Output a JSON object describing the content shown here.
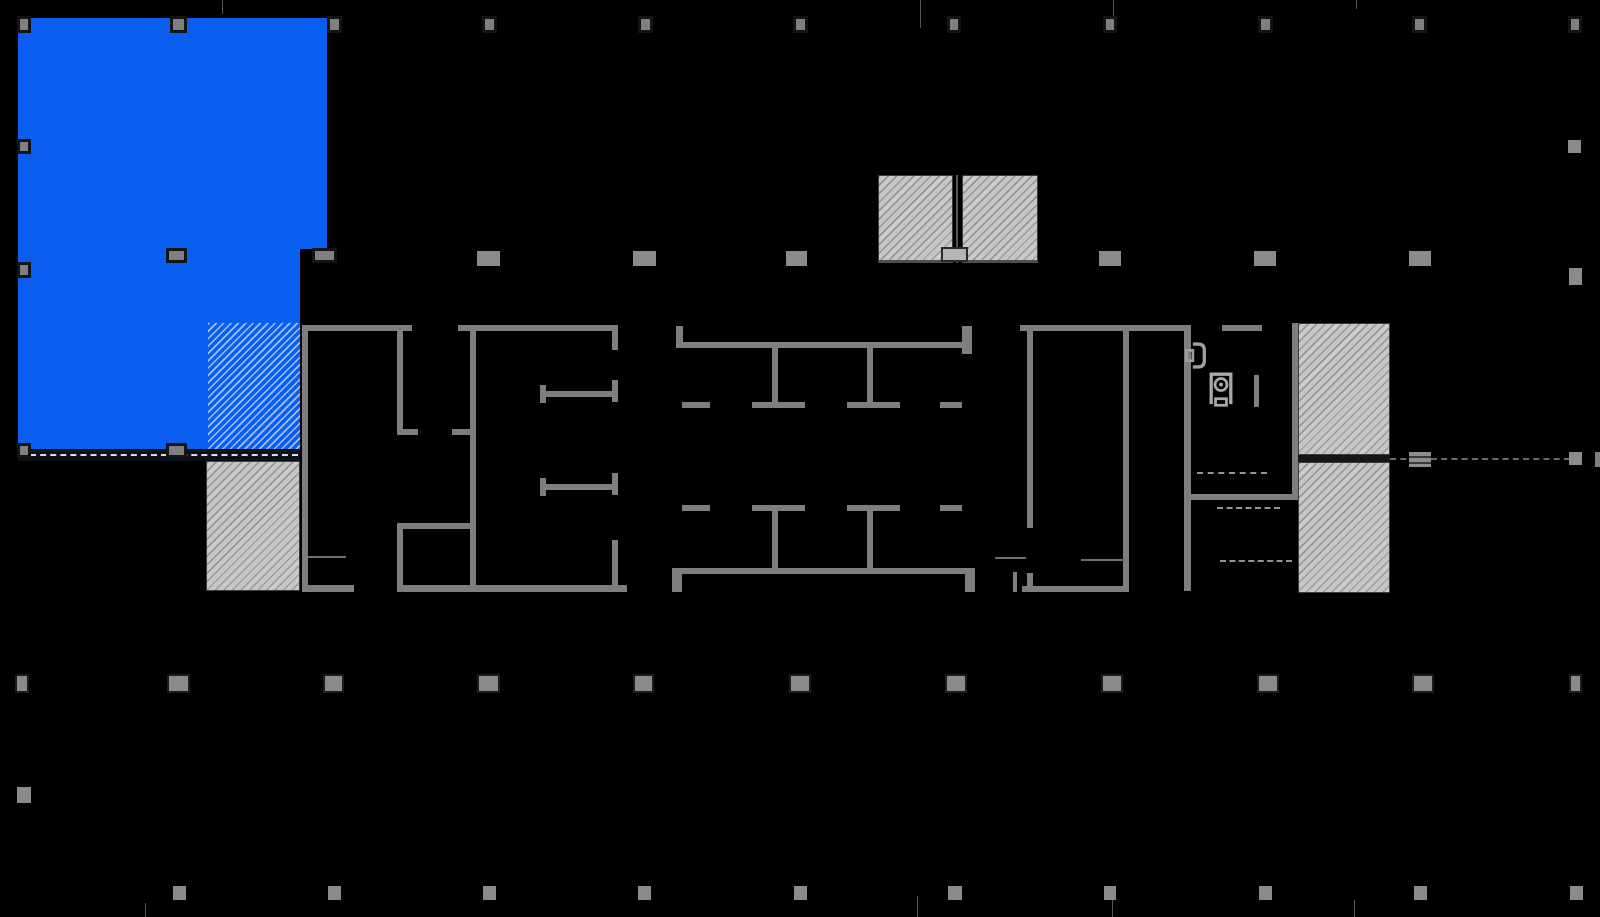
{
  "meta": {
    "width": 1600,
    "height": 917,
    "description": "building floor plan with highlighted suite"
  },
  "palette": {
    "background": "#000000",
    "wall_gray": "#7e7e7e",
    "suite_blue": "#0a5ff0",
    "hatch_gray": "#c6c6c6",
    "column_gray": "#8b8b8b"
  },
  "plan": {
    "elements": [
      {
        "name": "suite-highlight",
        "cls": "suite",
        "x": 18,
        "y": 18,
        "w": 309,
        "h": 231,
        "interactable": true
      },
      {
        "name": "suite-highlight",
        "cls": "suite",
        "x": 18,
        "y": 249,
        "w": 282,
        "h": 206,
        "interactable": true
      },
      {
        "name": "suite-highlight-hatched",
        "cls": "suite-hatch",
        "x": 208,
        "y": 323,
        "w": 92,
        "h": 132,
        "interactable": true
      },
      {
        "name": "suite-boundary-dashed",
        "cls": "suite-band",
        "x": 18,
        "y": 449,
        "w": 282,
        "h": 12
      },
      {
        "name": "shaft-hatch",
        "cls": "gray-hatch",
        "x": 206,
        "y": 461,
        "w": 94,
        "h": 130
      },
      {
        "name": "shaft-hatch",
        "cls": "gray-hatch shaft-top",
        "x": 878,
        "y": 175,
        "w": 75,
        "h": 88
      },
      {
        "name": "shaft-hatch",
        "cls": "gray-hatch shaft-top",
        "x": 962,
        "y": 175,
        "w": 76,
        "h": 88
      },
      {
        "name": "shaft-divider",
        "cls": "grid-tick",
        "x": 956,
        "y": 175,
        "w": 2,
        "h": 88
      },
      {
        "name": "shaft-door",
        "cls": "shaft-door",
        "x": 941,
        "y": 247,
        "w": 27,
        "h": 15
      },
      {
        "name": "shaft-hatch",
        "cls": "gray-hatch",
        "x": 1298,
        "y": 323,
        "w": 92,
        "h": 132
      },
      {
        "name": "shaft-hatch",
        "cls": "gray-hatch",
        "x": 1298,
        "y": 462,
        "w": 92,
        "h": 131
      },
      {
        "name": "shaft-gap-band",
        "cls": "dark-band",
        "x": 1298,
        "y": 455,
        "w": 92,
        "h": 7
      },
      {
        "name": "wall",
        "cls": "wall",
        "x": 302,
        "y": 325,
        "w": 6,
        "h": 266
      },
      {
        "name": "wall",
        "cls": "wall",
        "x": 302,
        "y": 325,
        "w": 110,
        "h": 6
      },
      {
        "name": "wall",
        "cls": "wall",
        "x": 458,
        "y": 325,
        "w": 160,
        "h": 6
      },
      {
        "name": "wall",
        "cls": "wall",
        "x": 397,
        "y": 331,
        "w": 6,
        "h": 103
      },
      {
        "name": "wall",
        "cls": "wall",
        "x": 397,
        "y": 429,
        "w": 21,
        "h": 6
      },
      {
        "name": "wall",
        "cls": "wall",
        "x": 452,
        "y": 429,
        "w": 24,
        "h": 6
      },
      {
        "name": "wall",
        "cls": "wall",
        "x": 470,
        "y": 331,
        "w": 6,
        "h": 260
      },
      {
        "name": "wall",
        "cls": "wall",
        "x": 397,
        "y": 523,
        "w": 79,
        "h": 6
      },
      {
        "name": "wall",
        "cls": "wall",
        "x": 397,
        "y": 529,
        "w": 6,
        "h": 62
      },
      {
        "name": "wall",
        "cls": "wall",
        "x": 540,
        "y": 391,
        "w": 78,
        "h": 6
      },
      {
        "name": "wall",
        "cls": "wall",
        "x": 540,
        "y": 385,
        "w": 6,
        "h": 18
      },
      {
        "name": "wall",
        "cls": "wall",
        "x": 540,
        "y": 484,
        "w": 78,
        "h": 6
      },
      {
        "name": "wall",
        "cls": "wall",
        "x": 540,
        "y": 478,
        "w": 6,
        "h": 18
      },
      {
        "name": "wall",
        "cls": "wall",
        "x": 612,
        "y": 325,
        "w": 6,
        "h": 25
      },
      {
        "name": "wall",
        "cls": "wall",
        "x": 612,
        "y": 380,
        "w": 6,
        "h": 22
      },
      {
        "name": "wall",
        "cls": "wall",
        "x": 612,
        "y": 473,
        "w": 6,
        "h": 22
      },
      {
        "name": "wall",
        "cls": "wall",
        "x": 612,
        "y": 540,
        "w": 6,
        "h": 52
      },
      {
        "name": "wall",
        "cls": "wall",
        "x": 302,
        "y": 585,
        "w": 52,
        "h": 7
      },
      {
        "name": "wall",
        "cls": "wall",
        "x": 397,
        "y": 585,
        "w": 230,
        "h": 7
      },
      {
        "name": "counter-line",
        "cls": "thin-line",
        "x": 308,
        "y": 556,
        "w": 38,
        "h": 2
      },
      {
        "name": "wall",
        "cls": "wall",
        "x": 676,
        "y": 326,
        "w": 7,
        "h": 22
      },
      {
        "name": "wall",
        "cls": "wall",
        "x": 962,
        "y": 326,
        "w": 10,
        "h": 28
      },
      {
        "name": "wall",
        "cls": "wall",
        "x": 682,
        "y": 342,
        "w": 280,
        "h": 6
      },
      {
        "name": "wall",
        "cls": "wall",
        "x": 772,
        "y": 348,
        "w": 6,
        "h": 60
      },
      {
        "name": "wall",
        "cls": "wall",
        "x": 867,
        "y": 348,
        "w": 6,
        "h": 60
      },
      {
        "name": "wall",
        "cls": "wall",
        "x": 682,
        "y": 402,
        "w": 28,
        "h": 6
      },
      {
        "name": "wall",
        "cls": "wall",
        "x": 752,
        "y": 402,
        "w": 53,
        "h": 6
      },
      {
        "name": "wall",
        "cls": "wall",
        "x": 847,
        "y": 402,
        "w": 53,
        "h": 6
      },
      {
        "name": "wall",
        "cls": "wall",
        "x": 940,
        "y": 402,
        "w": 22,
        "h": 6
      },
      {
        "name": "wall",
        "cls": "wall",
        "x": 682,
        "y": 505,
        "w": 28,
        "h": 6
      },
      {
        "name": "wall",
        "cls": "wall",
        "x": 752,
        "y": 505,
        "w": 53,
        "h": 6
      },
      {
        "name": "wall",
        "cls": "wall",
        "x": 847,
        "y": 505,
        "w": 53,
        "h": 6
      },
      {
        "name": "wall",
        "cls": "wall",
        "x": 940,
        "y": 505,
        "w": 22,
        "h": 6
      },
      {
        "name": "wall",
        "cls": "wall",
        "x": 772,
        "y": 511,
        "w": 6,
        "h": 57
      },
      {
        "name": "wall",
        "cls": "wall",
        "x": 867,
        "y": 511,
        "w": 6,
        "h": 57
      },
      {
        "name": "wall",
        "cls": "wall",
        "x": 682,
        "y": 568,
        "w": 283,
        "h": 6
      },
      {
        "name": "wall",
        "cls": "wall",
        "x": 672,
        "y": 568,
        "w": 10,
        "h": 24
      },
      {
        "name": "wall",
        "cls": "wall",
        "x": 965,
        "y": 568,
        "w": 10,
        "h": 24
      },
      {
        "name": "wall",
        "cls": "wall",
        "x": 1013,
        "y": 572,
        "w": 4,
        "h": 20
      },
      {
        "name": "door-line",
        "cls": "thin-line",
        "x": 995,
        "y": 557,
        "w": 31,
        "h": 2
      },
      {
        "name": "wall",
        "cls": "wall",
        "x": 1020,
        "y": 325,
        "w": 170,
        "h": 6
      },
      {
        "name": "wall",
        "cls": "wall",
        "x": 1222,
        "y": 325,
        "w": 40,
        "h": 6
      },
      {
        "name": "wall",
        "cls": "wall",
        "x": 1027,
        "y": 331,
        "w": 6,
        "h": 197
      },
      {
        "name": "wall",
        "cls": "wall",
        "x": 1027,
        "y": 573,
        "w": 6,
        "h": 19
      },
      {
        "name": "wall",
        "cls": "wall",
        "x": 1123,
        "y": 331,
        "w": 6,
        "h": 261
      },
      {
        "name": "wall",
        "cls": "wall",
        "x": 1022,
        "y": 586,
        "w": 107,
        "h": 6
      },
      {
        "name": "wall",
        "cls": "wall",
        "x": 1184,
        "y": 325,
        "w": 7,
        "h": 266
      },
      {
        "name": "wall",
        "cls": "wall",
        "x": 1292,
        "y": 323,
        "w": 6,
        "h": 177
      },
      {
        "name": "wall",
        "cls": "wall",
        "x": 1184,
        "y": 494,
        "w": 114,
        "h": 6
      },
      {
        "name": "wall",
        "cls": "wall",
        "x": 1254,
        "y": 375,
        "w": 5,
        "h": 32
      },
      {
        "name": "counter-line",
        "cls": "thin-line",
        "x": 1081,
        "y": 559,
        "w": 44,
        "h": 2
      },
      {
        "name": "wall",
        "cls": "wall",
        "x": 1595,
        "y": 452,
        "w": 5,
        "h": 15
      },
      {
        "name": "dashed-partition",
        "cls": "dash",
        "x": 1197,
        "y": 472,
        "w": 70
      },
      {
        "name": "dashed-partition",
        "cls": "dash",
        "x": 1217,
        "y": 507,
        "w": 63
      },
      {
        "name": "dashed-partition",
        "cls": "dash",
        "x": 1220,
        "y": 560,
        "w": 72
      },
      {
        "name": "dashed-gridline",
        "cls": "dash-dim",
        "x": 1390,
        "y": 458,
        "w": 180
      },
      {
        "name": "grid-tick",
        "cls": "grid-tick",
        "x": 222,
        "y": 0,
        "w": 1,
        "h": 14
      },
      {
        "name": "grid-tick",
        "cls": "grid-tick",
        "x": 920,
        "y": 0,
        "w": 1,
        "h": 28
      },
      {
        "name": "grid-tick",
        "cls": "grid-tick",
        "x": 1113,
        "y": 0,
        "w": 1,
        "h": 28
      },
      {
        "name": "grid-tick",
        "cls": "grid-tick",
        "x": 1356,
        "y": 0,
        "w": 1,
        "h": 9
      },
      {
        "name": "grid-tick",
        "cls": "grid-tick",
        "x": 145,
        "y": 903,
        "w": 1,
        "h": 14
      },
      {
        "name": "grid-tick",
        "cls": "grid-tick",
        "x": 917,
        "y": 896,
        "w": 1,
        "h": 21
      },
      {
        "name": "grid-tick",
        "cls": "grid-tick",
        "x": 1112,
        "y": 896,
        "w": 1,
        "h": 21
      },
      {
        "name": "grid-tick",
        "cls": "grid-tick",
        "x": 1354,
        "y": 900,
        "w": 1,
        "h": 17
      },
      {
        "name": "structural-column",
        "cls": "col-b",
        "x": 17,
        "y": 16,
        "w": 14,
        "h": 17
      },
      {
        "name": "structural-column",
        "cls": "col-b",
        "x": 170,
        "y": 16,
        "w": 17,
        "h": 17
      },
      {
        "name": "structural-column",
        "cls": "col-b",
        "x": 327,
        "y": 16,
        "w": 15,
        "h": 17
      },
      {
        "name": "structural-column",
        "cls": "col-b",
        "x": 482,
        "y": 16,
        "w": 15,
        "h": 17
      },
      {
        "name": "structural-column",
        "cls": "col-b",
        "x": 638,
        "y": 16,
        "w": 15,
        "h": 17
      },
      {
        "name": "structural-column",
        "cls": "col-b",
        "x": 793,
        "y": 16,
        "w": 15,
        "h": 17
      },
      {
        "name": "structural-column",
        "cls": "col-b",
        "x": 947,
        "y": 16,
        "w": 14,
        "h": 17
      },
      {
        "name": "structural-column",
        "cls": "col-b",
        "x": 1103,
        "y": 16,
        "w": 14,
        "h": 17
      },
      {
        "name": "structural-column",
        "cls": "col-b",
        "x": 1258,
        "y": 16,
        "w": 15,
        "h": 17
      },
      {
        "name": "structural-column",
        "cls": "col-b",
        "x": 1412,
        "y": 16,
        "w": 15,
        "h": 17
      },
      {
        "name": "structural-column",
        "cls": "col-b",
        "x": 1568,
        "y": 16,
        "w": 14,
        "h": 17
      },
      {
        "name": "structural-column",
        "cls": "col-b",
        "x": 17,
        "y": 139,
        "w": 14,
        "h": 15
      },
      {
        "name": "structural-column",
        "cls": "col-p",
        "x": 1568,
        "y": 140,
        "w": 13,
        "h": 13
      },
      {
        "name": "structural-column",
        "cls": "col-b",
        "x": 166,
        "y": 248,
        "w": 21,
        "h": 15
      },
      {
        "name": "structural-column",
        "cls": "col-b",
        "x": 312,
        "y": 248,
        "w": 25,
        "h": 15
      },
      {
        "name": "structural-column",
        "cls": "col-p",
        "x": 477,
        "y": 251,
        "w": 23,
        "h": 15
      },
      {
        "name": "structural-column",
        "cls": "col-p",
        "x": 633,
        "y": 251,
        "w": 23,
        "h": 15
      },
      {
        "name": "structural-column",
        "cls": "col-p",
        "x": 786,
        "y": 251,
        "w": 21,
        "h": 15
      },
      {
        "name": "structural-column",
        "cls": "col-p",
        "x": 1099,
        "y": 251,
        "w": 22,
        "h": 15
      },
      {
        "name": "structural-column",
        "cls": "col-p",
        "x": 1254,
        "y": 251,
        "w": 22,
        "h": 15
      },
      {
        "name": "structural-column",
        "cls": "col-p",
        "x": 1409,
        "y": 251,
        "w": 22,
        "h": 15
      },
      {
        "name": "structural-column",
        "cls": "col-b",
        "x": 17,
        "y": 262,
        "w": 14,
        "h": 16
      },
      {
        "name": "structural-column",
        "cls": "col-p",
        "x": 1569,
        "y": 268,
        "w": 13,
        "h": 17
      },
      {
        "name": "structural-column",
        "cls": "col-b",
        "x": 17,
        "y": 443,
        "w": 14,
        "h": 15
      },
      {
        "name": "structural-column",
        "cls": "col-b",
        "x": 166,
        "y": 443,
        "w": 21,
        "h": 15
      },
      {
        "name": "structural-column",
        "cls": "col-s",
        "x": 1409,
        "y": 452,
        "w": 22,
        "h": 15
      },
      {
        "name": "structural-column",
        "cls": "col-p",
        "x": 1569,
        "y": 452,
        "w": 13,
        "h": 13
      },
      {
        "name": "structural-column",
        "cls": "col-d",
        "x": 15,
        "y": 674,
        "w": 14,
        "h": 19
      },
      {
        "name": "structural-column",
        "cls": "col-d",
        "x": 167,
        "y": 674,
        "w": 23,
        "h": 19
      },
      {
        "name": "structural-column",
        "cls": "col-d",
        "x": 323,
        "y": 674,
        "w": 21,
        "h": 19
      },
      {
        "name": "structural-column",
        "cls": "col-d",
        "x": 477,
        "y": 674,
        "w": 23,
        "h": 19
      },
      {
        "name": "structural-column",
        "cls": "col-d",
        "x": 633,
        "y": 674,
        "w": 21,
        "h": 19
      },
      {
        "name": "structural-column",
        "cls": "col-d",
        "x": 789,
        "y": 674,
        "w": 22,
        "h": 19
      },
      {
        "name": "structural-column",
        "cls": "col-d",
        "x": 945,
        "y": 674,
        "w": 22,
        "h": 19
      },
      {
        "name": "structural-column",
        "cls": "col-d",
        "x": 1101,
        "y": 674,
        "w": 22,
        "h": 19
      },
      {
        "name": "structural-column",
        "cls": "col-d",
        "x": 1257,
        "y": 674,
        "w": 22,
        "h": 19
      },
      {
        "name": "structural-column",
        "cls": "col-d",
        "x": 1412,
        "y": 674,
        "w": 22,
        "h": 19
      },
      {
        "name": "structural-column",
        "cls": "col-d",
        "x": 1569,
        "y": 674,
        "w": 13,
        "h": 19
      },
      {
        "name": "structural-column",
        "cls": "col-p",
        "x": 17,
        "y": 787,
        "w": 14,
        "h": 16
      },
      {
        "name": "structural-column",
        "cls": "col-p",
        "x": 173,
        "y": 886,
        "w": 13,
        "h": 14
      },
      {
        "name": "structural-column",
        "cls": "col-p",
        "x": 328,
        "y": 886,
        "w": 13,
        "h": 14
      },
      {
        "name": "structural-column",
        "cls": "col-p",
        "x": 483,
        "y": 886,
        "w": 13,
        "h": 14
      },
      {
        "name": "structural-column",
        "cls": "col-p",
        "x": 638,
        "y": 886,
        "w": 13,
        "h": 14
      },
      {
        "name": "structural-column",
        "cls": "col-p",
        "x": 794,
        "y": 886,
        "w": 13,
        "h": 14
      },
      {
        "name": "structural-column",
        "cls": "col-p",
        "x": 948,
        "y": 886,
        "w": 14,
        "h": 14
      },
      {
        "name": "structural-column",
        "cls": "col-p",
        "x": 1104,
        "y": 886,
        "w": 12,
        "h": 14
      },
      {
        "name": "structural-column",
        "cls": "col-p",
        "x": 1259,
        "y": 886,
        "w": 13,
        "h": 14
      },
      {
        "name": "structural-column",
        "cls": "col-p",
        "x": 1414,
        "y": 886,
        "w": 13,
        "h": 14
      },
      {
        "name": "structural-column",
        "cls": "col-p",
        "x": 1570,
        "y": 886,
        "w": 13,
        "h": 14
      },
      {
        "name": "toilet-icon",
        "cls": "fixture",
        "x": 1209,
        "y": 371,
        "w": 24,
        "h": 38,
        "svg": "toilet-svg"
      },
      {
        "name": "fountain-icon",
        "cls": "fixture",
        "x": 1185,
        "y": 342,
        "w": 22,
        "h": 27,
        "svg": "fountain-svg"
      }
    ]
  }
}
